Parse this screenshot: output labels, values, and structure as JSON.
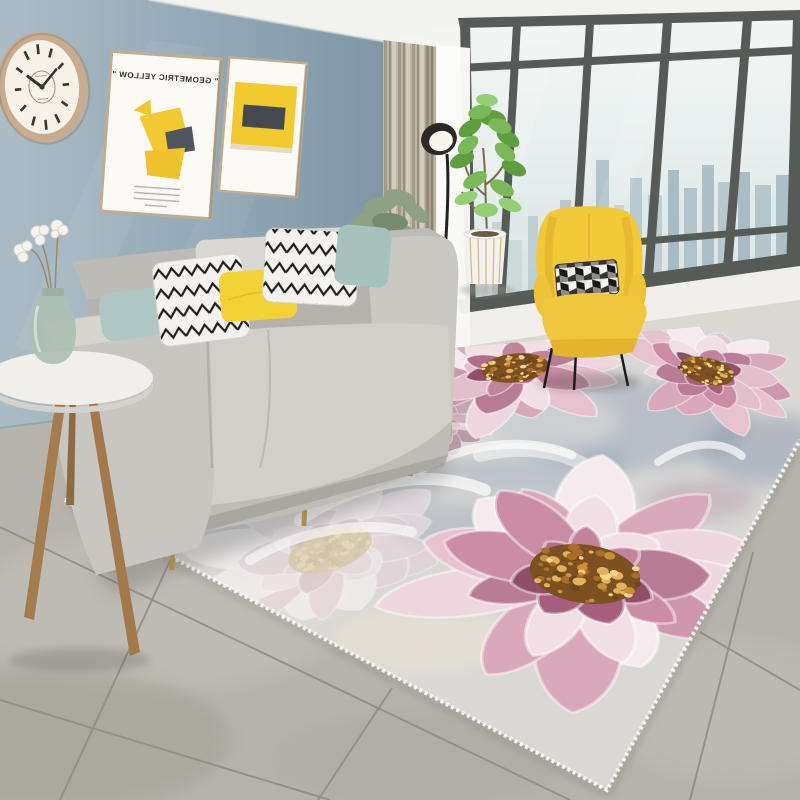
{
  "scene": {
    "description": "Modern living room product photo featuring a large pink peony floral area rug",
    "poster": {
      "title_left": "\" GEOMETRIC YELLOW \"",
      "mirrored": true
    },
    "clock_time": "10:09",
    "palette": {
      "wall_blue": "#8fa5b4",
      "ceiling": "#f4f4f1",
      "sofa_gray": "#cccbc5",
      "pillow_teal": "#aec7c4",
      "pillow_yellow": "#f2d235",
      "chair_yellow": "#f2c937",
      "curtain_beige": "#b9b1a1",
      "window_frame": "#565b58",
      "tile_gray": "#b6b3ab",
      "rug_base": "#d9d8d5",
      "flower_pink": "#d9a8bb",
      "flower_deep": "#a55f7d",
      "flower_center_gold": "#c7913c"
    },
    "rug": {
      "palettes": {
        "vivid": {
          "outer": [
            "#e7c2cf",
            "#f5ebee",
            "#d9a8bb",
            "#eed7de",
            "#cf97ad"
          ],
          "mid": [
            "#cb8da6",
            "#f0e0e6",
            "#b97c95",
            "#e3bfcb"
          ],
          "inner": [
            "#a55f7d",
            "#c2849d",
            "#8f4f6b",
            "#b06d89"
          ],
          "center": [
            "#7c5020",
            "#c7913c",
            "#e2b35c",
            "#f3d88a",
            "#6f4618",
            "#a86f2a"
          ]
        },
        "pale": {
          "outer": [
            "#efe0e6",
            "#f8f3f5",
            "#e6d2da"
          ],
          "mid": [
            "#e8d5dc",
            "#f3e9ed"
          ],
          "inner": [
            "#ddc2cc",
            "#ecdce2"
          ],
          "center": [
            "#d9c49a",
            "#e8d7b0",
            "#cfb98d"
          ]
        },
        "deep": {
          "outer": [
            "#b07a92",
            "#c995aa",
            "#9c6680"
          ],
          "mid": [
            "#a86c86",
            "#bf8ba0"
          ],
          "inner": [
            "#8f5570",
            "#a4667f"
          ],
          "center": [
            "#6f4618",
            "#a87a3a",
            "#8a5a22"
          ]
        }
      },
      "flowers": [
        {
          "cx": 433,
          "cy": 422,
          "sx": 0.62,
          "sy": 0.38,
          "rot": 0,
          "seed": 9,
          "pal": "deep",
          "o": 0.55,
          "layer": "back"
        },
        {
          "cx": 330,
          "cy": 550,
          "sx": 1.45,
          "sy": 0.85,
          "rot": -18,
          "seed": 5,
          "pal": "pale",
          "o": 0.6,
          "layer": "back"
        },
        {
          "cx": 515,
          "cy": 368,
          "sx": 1.12,
          "sy": 0.6,
          "rot": -6,
          "seed": 7,
          "pal": "vivid",
          "o": 1,
          "layer": "front"
        },
        {
          "cx": 707,
          "cy": 371,
          "sx": 0.92,
          "sy": 0.55,
          "rot": 14,
          "seed": 3,
          "pal": "vivid",
          "o": 1,
          "layer": "front"
        },
        {
          "cx": 585,
          "cy": 574,
          "sx": 1.85,
          "sy": 1.22,
          "rot": 8,
          "seed": 11,
          "pal": "vivid",
          "o": 1,
          "layer": "front"
        }
      ],
      "patches": [
        {
          "x": 620,
          "y": 425,
          "rx": 130,
          "ry": 45,
          "c": "#8fa0b7",
          "o": 0.45
        },
        {
          "x": 770,
          "y": 450,
          "rx": 70,
          "ry": 35,
          "c": "#7b8ca6",
          "o": 0.4
        },
        {
          "x": 540,
          "y": 468,
          "rx": 90,
          "ry": 30,
          "c": "#95a5ba",
          "o": 0.4
        },
        {
          "x": 350,
          "y": 480,
          "rx": 100,
          "ry": 35,
          "c": "#8d9db4",
          "o": 0.38
        },
        {
          "x": 460,
          "y": 528,
          "rx": 70,
          "ry": 25,
          "c": "#8a9ab1",
          "o": 0.35
        },
        {
          "x": 255,
          "y": 520,
          "rx": 80,
          "ry": 30,
          "c": "#9fadbf",
          "o": 0.35
        },
        {
          "x": 355,
          "y": 420,
          "rx": 90,
          "ry": 30,
          "c": "#9f7b95",
          "o": 0.4
        },
        {
          "x": 300,
          "y": 468,
          "rx": 60,
          "ry": 22,
          "c": "#a887a0",
          "o": 0.35
        },
        {
          "x": 700,
          "y": 500,
          "rx": 55,
          "ry": 20,
          "c": "#9f7b95",
          "o": 0.3
        },
        {
          "x": 420,
          "y": 640,
          "rx": 90,
          "ry": 35,
          "c": "#e9e2d2",
          "o": 0.6
        },
        {
          "x": 290,
          "y": 598,
          "rx": 60,
          "ry": 25,
          "c": "#ece5d6",
          "o": 0.5
        },
        {
          "x": 500,
          "y": 420,
          "rx": 120,
          "ry": 40,
          "c": "#e3e2df",
          "o": 0.5
        }
      ]
    },
    "floor": {
      "grout": [
        {
          "x1": 0,
          "y1": 527,
          "x2": 570,
          "y2": 800
        },
        {
          "x1": 0,
          "y1": 700,
          "x2": 330,
          "y2": 800
        },
        {
          "x1": 238,
          "y1": 413,
          "x2": 60,
          "y2": 800
        },
        {
          "x1": 392,
          "y1": 688,
          "x2": 318,
          "y2": 800
        },
        {
          "x1": 753,
          "y1": 552,
          "x2": 690,
          "y2": 800
        },
        {
          "x1": 700,
          "y1": 632,
          "x2": 800,
          "y2": 690
        }
      ],
      "patches": [
        {
          "x": 160,
          "y": 610,
          "rx": 190,
          "ry": 80,
          "c": "#c6c3ba",
          "o": 0.5
        },
        {
          "x": 60,
          "y": 740,
          "rx": 170,
          "ry": 70,
          "c": "#9e9b90",
          "o": 0.45
        },
        {
          "x": 730,
          "y": 710,
          "rx": 120,
          "ry": 70,
          "c": "#c2bfb6",
          "o": 0.5
        },
        {
          "x": 420,
          "y": 760,
          "rx": 150,
          "ry": 50,
          "c": "#aba89e",
          "o": 0.4
        }
      ]
    }
  }
}
